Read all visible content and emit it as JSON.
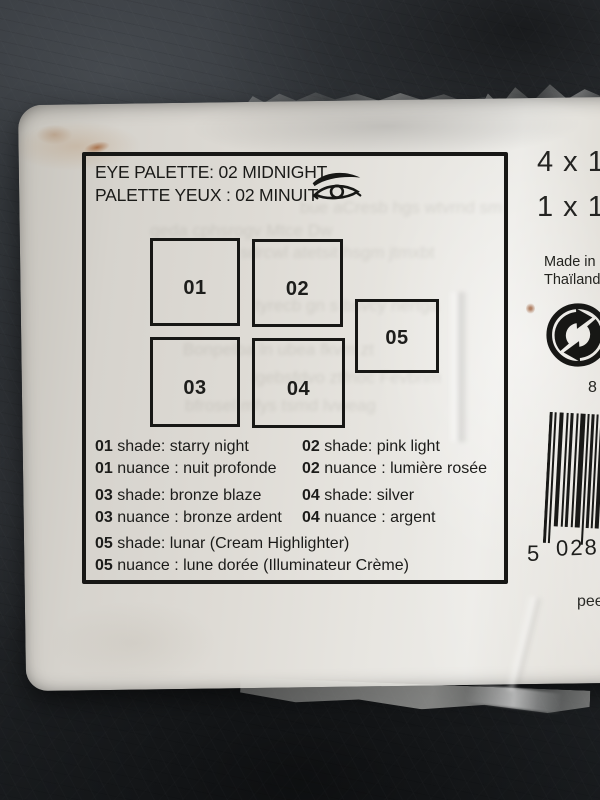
{
  "header": {
    "title_en": "EYE PALETTE: 02 MIDNIGHT",
    "title_fr": "PALETTE YEUX : 02 MINUIT"
  },
  "pans": [
    "01",
    "02",
    "03",
    "04",
    "05"
  ],
  "shades": [
    {
      "num": "01",
      "en": "shade: starry night",
      "fr": "nuance : nuit profonde"
    },
    {
      "num": "02",
      "en": "shade: pink light",
      "fr": "nuance : lumière rosée"
    },
    {
      "num": "03",
      "en": "shade: bronze blaze",
      "fr": "nuance : bronze ardent"
    },
    {
      "num": "04",
      "en": "shade: silver",
      "fr": "nuance : argent"
    },
    {
      "num": "05",
      "en": "shade: lunar (Cream Highlighter)",
      "fr": "nuance : lune dorée (Illuminateur Crème)"
    }
  ],
  "side": {
    "qty_line1": "4 x 1",
    "qty_line2": "1 x 1",
    "made_in_1": "Made in",
    "made_in_2": "Thaïlande",
    "partial_number": "8",
    "barcode_left": "5",
    "barcode_main": "028",
    "peel": "peel"
  },
  "icons": {
    "eye": "eye-icon",
    "green_dot": "green-dot-recycling-icon",
    "barcode": "barcode"
  },
  "colors": {
    "label": "#dcd9d3",
    "ink": "#1d1d1b",
    "background": "#2c2f33"
  },
  "ghost_lines": [
    "bue aCresb hgs wtvrnd sm",
    "qeda cphsrogv Mtce Dw",
    "sdrcwl atetsit hsgm jtmxbt",
    "tyrecb gn s bsvcy nertga",
    "Bonpelba ln ubea fkvm zt",
    "lgebsfdvo ztfnoc Fevbnm",
    "bfrosel mfys tsmd lvweag"
  ]
}
